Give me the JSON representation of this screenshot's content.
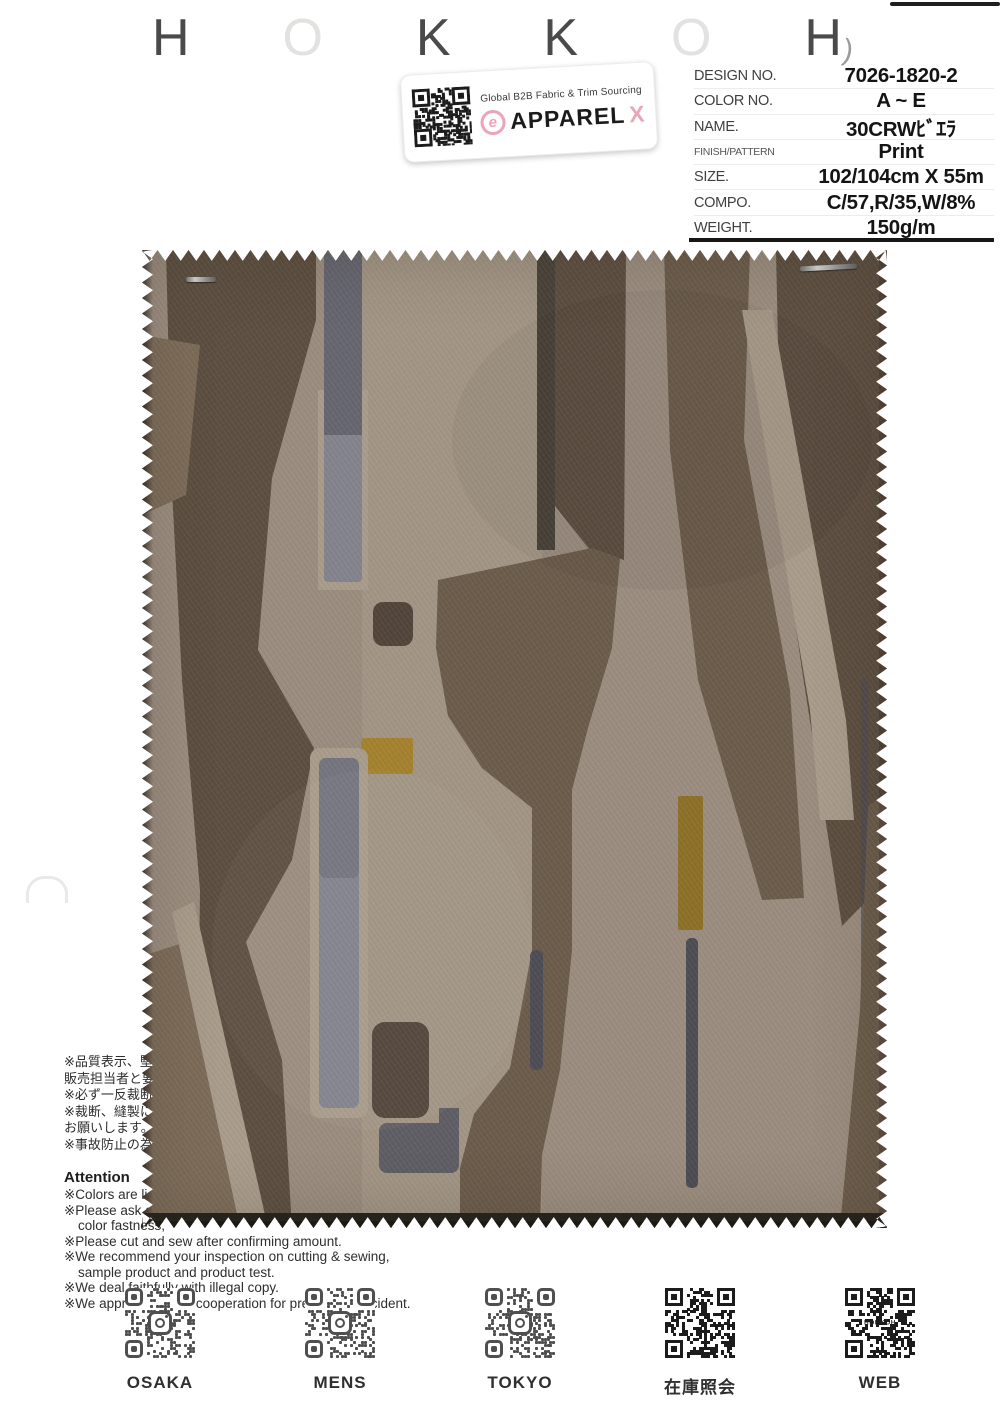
{
  "header": {
    "letters": [
      "H",
      "O",
      "K",
      "K",
      "O",
      "H"
    ],
    "paren": ")"
  },
  "sticker": {
    "tagline": "Global B2B Fabric & Trim Sourcing",
    "brand": "APPAREL",
    "brand_x": "X",
    "logo_letter": "e"
  },
  "specs": {
    "rows": [
      {
        "label": "DESIGN NO.",
        "value": "7026-1820-2"
      },
      {
        "label": "COLOR NO.",
        "value": "A ~ E"
      },
      {
        "label": "NAME.",
        "value": "30CRWﾋﾞｴﾗ"
      },
      {
        "label": "FINISH/PATTERN",
        "value": "Print"
      },
      {
        "label": "SIZE.",
        "value": "102/104cm X 55m"
      },
      {
        "label": "COMPO.",
        "value": "C/57,R/35,W/8%"
      },
      {
        "label": "WEIGHT.",
        "value": "150g/m"
      }
    ]
  },
  "notes_jp": {
    "lines": [
      "※品質表示、堅牢度については",
      "販売担当者と要確認ください。",
      "※必ず一反裁断をお願いします。",
      "※裁断、縫製にての返品はご容赦",
      "お願いします。",
      "※事故防止の為、ご注意ください。"
    ]
  },
  "attention": {
    "title": "Attention",
    "lines": [
      "※Colors are listed on this swatch.",
      "※Please ask our sales person about",
      "color fastness,",
      "※Please cut and sew after confirming amount.",
      "※We recommend your inspection on cutting & sewing,",
      "sample product and product test.",
      "※We deal faithfully with illegal copy.",
      "※We appreciate your cooperation for preventing accident."
    ]
  },
  "qr_section": {
    "items": [
      {
        "label": "OSAKA",
        "style": "instagram"
      },
      {
        "label": "MENS",
        "style": "instagram"
      },
      {
        "label": "TOKYO",
        "style": "instagram"
      },
      {
        "label": "在庫照会",
        "style": "dense"
      },
      {
        "label": "WEB",
        "style": "dense",
        "badge": "HOKKOH"
      }
    ]
  },
  "colors": {
    "fabric_base": "#9a8c7e",
    "fabric_light": "#a89b8a",
    "fabric_dark": "#5c4e40",
    "fabric_dark2": "#51453a",
    "fabric_medium": "#6b5b4a",
    "fabric_medium2": "#7c6b58",
    "gray_blue": "#83838d",
    "gray_blue_dark": "#60606a",
    "slate": "#4c4c53",
    "slate_light": "#5e5d63",
    "mustard": "#a3812e",
    "mustard_dark": "#8c7028",
    "thin_bar": "#49423a",
    "brand_pink": "#eba4b8",
    "letter_gray": "#4a4a4a",
    "letter_faint": "#e4e2e0"
  }
}
